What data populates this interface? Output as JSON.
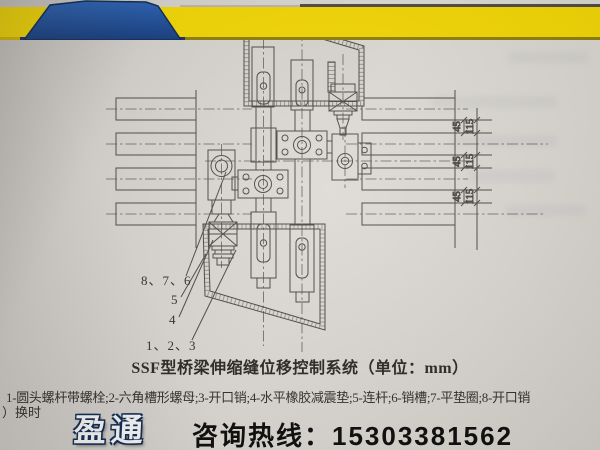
{
  "page": {
    "caption": "SSF型桥梁伸缩缝位移控制系统（单位：mm）",
    "legend": "1-圆头螺杆带螺栓;2-六角槽形螺母;3-开口销;4-水平橡胶减震垫;5-连杆;6-销槽;7-平垫圈;8-开口销",
    "legend_overflow": "）换时"
  },
  "drawing": {
    "labels": {
      "pins_876": "8、7、6",
      "rod_5": "5",
      "pad_4": "4",
      "bolts_123": "1、2、3"
    },
    "dims": {
      "d45": "45",
      "d115": "115"
    },
    "ink_color": "#4e4a45"
  },
  "banner": {
    "brand": "盈通",
    "hotline": "咨询热线：15303381562",
    "colors": {
      "yellow": "#f3d703",
      "blue": "#1d4f9e",
      "navy": "#0d2a55",
      "bottom_olive": "#8f7e08",
      "hotline_text": "#0c0c0c"
    }
  }
}
